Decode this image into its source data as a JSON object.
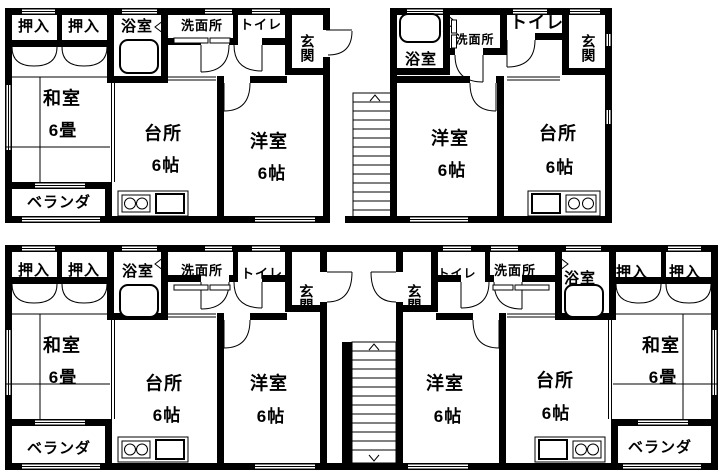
{
  "document": {
    "type": "floor-plan",
    "background": "#ffffff"
  },
  "colors": {
    "wall": "#000000",
    "line": "#000000",
    "background": "#ffffff"
  },
  "labels": {
    "closet": "押入",
    "bathroom": "浴室",
    "washroom": "洗面所",
    "toilet": "トイレ",
    "entrance": "玄関",
    "japanese_room": "和室",
    "japanese_room_size": "6畳",
    "kitchen": "台所",
    "kitchen_size": "6帖",
    "western_room": "洋室",
    "western_room_size": "6帖",
    "veranda": "ベランダ"
  },
  "units": [
    {
      "location": "top-left",
      "rooms": [
        "押入",
        "押入",
        "浴室",
        "洗面所",
        "トイレ",
        "玄関",
        "和室 6畳",
        "台所 6帖",
        "洋室 6帖",
        "ベランダ"
      ]
    },
    {
      "location": "top-right",
      "rooms": [
        "浴室",
        "洗面所",
        "トイレ",
        "玄関",
        "洋室 6帖",
        "台所 6帖"
      ]
    },
    {
      "location": "bottom-left",
      "rooms": [
        "押入",
        "押入",
        "浴室",
        "洗面所",
        "トイレ",
        "玄関",
        "和室 6畳",
        "台所 6帖",
        "洋室 6帖",
        "ベランダ"
      ]
    },
    {
      "location": "bottom-right",
      "rooms": [
        "押入",
        "押入",
        "浴室",
        "洗面所",
        "トイレ",
        "玄関",
        "和室 6畳",
        "台所 6帖",
        "洋室 6帖",
        "ベランダ"
      ]
    }
  ]
}
